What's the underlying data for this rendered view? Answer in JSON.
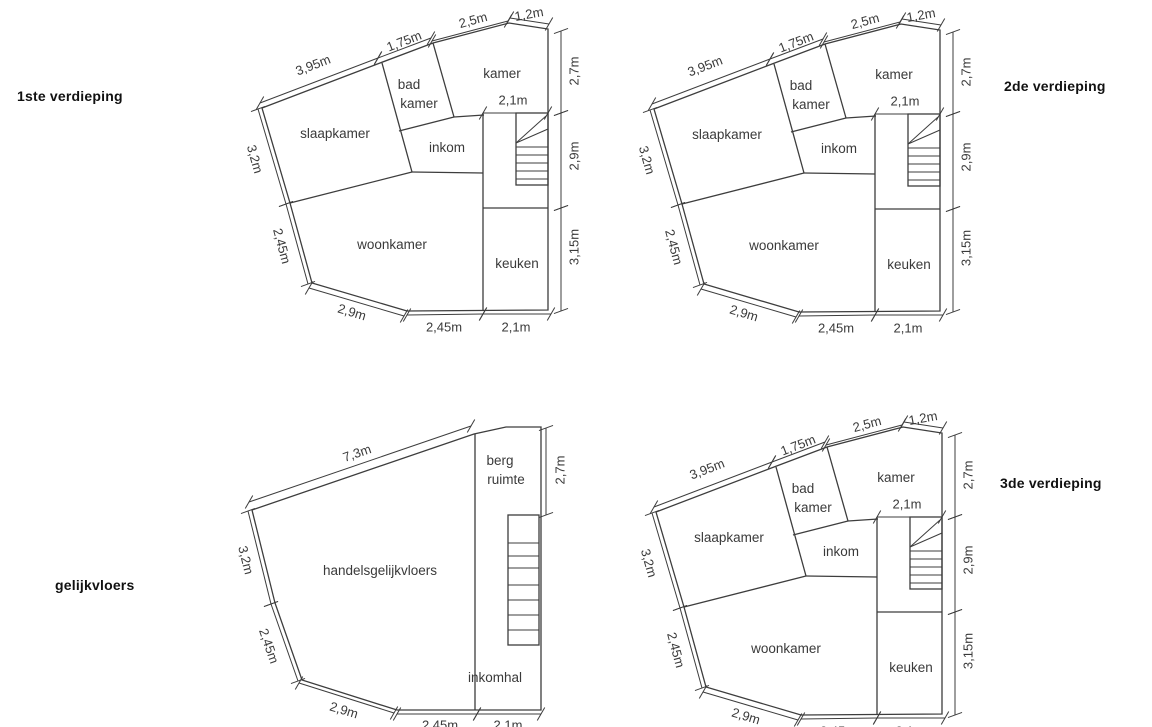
{
  "colors": {
    "background": "#ffffff",
    "line": "#3d3d3d",
    "text": "#3a3a3a",
    "floor_label": "#111111"
  },
  "plans": [
    {
      "id": "1ste-verdieping",
      "label": "1ste verdieping",
      "label_pos": [
        17,
        88
      ],
      "geometry": "standard",
      "offset": [
        0,
        0
      ]
    },
    {
      "id": "2de-verdieping",
      "label": "2de verdieping",
      "label_pos": [
        1004,
        78
      ],
      "geometry": "standard",
      "offset": [
        392,
        1
      ]
    },
    {
      "id": "gelijkvloers",
      "label": "gelijkvloers",
      "label_pos": [
        55,
        577
      ],
      "geometry": "ground",
      "offset": [
        0,
        0
      ]
    },
    {
      "id": "3de-verdieping",
      "label": "3de verdieping",
      "label_pos": [
        1000,
        475
      ],
      "geometry": "standard",
      "offset": [
        394,
        404
      ]
    }
  ],
  "geometries": {
    "standard": {
      "outline": [
        [
          262,
          108
        ],
        [
          380,
          63
        ],
        [
          433,
          43
        ],
        [
          509,
          23
        ],
        [
          548,
          29
        ],
        [
          548,
          310
        ],
        [
          407,
          311
        ],
        [
          312,
          283
        ],
        [
          290,
          203
        ]
      ],
      "walls": [
        [
          382,
          63,
          412,
          172
        ],
        [
          399,
          131,
          454,
          117
        ],
        [
          433,
          43,
          454,
          117
        ],
        [
          454,
          117,
          484,
          115
        ],
        [
          412,
          172,
          483,
          173
        ],
        [
          290,
          203,
          412,
          172
        ],
        [
          483,
          113,
          483,
          310
        ],
        [
          483,
          208,
          548,
          208
        ]
      ],
      "stairs": {
        "box": [
          516,
          113,
          548,
          185
        ],
        "treads": [
          147,
          155,
          163,
          171,
          179
        ],
        "arrows": [
          [
            516,
            143,
            546,
            116
          ],
          [
            516,
            143,
            548,
            129
          ]
        ]
      },
      "rooms": [
        {
          "label": "slaapkamer",
          "lines": [
            {
              "t": "slaapkamer",
              "x": 335,
              "y": 138
            }
          ]
        },
        {
          "label": "bad kamer",
          "lines": [
            {
              "t": "bad",
              "x": 409,
              "y": 89
            },
            {
              "t": "kamer",
              "x": 419,
              "y": 108
            }
          ]
        },
        {
          "label": "kamer",
          "lines": [
            {
              "t": "kamer",
              "x": 502,
              "y": 78
            }
          ]
        },
        {
          "label": "inkom",
          "lines": [
            {
              "t": "inkom",
              "x": 447,
              "y": 152
            }
          ]
        },
        {
          "label": "woonkamer",
          "lines": [
            {
              "t": "woonkamer",
              "x": 392,
              "y": 249
            }
          ]
        },
        {
          "label": "keuken",
          "lines": [
            {
              "t": "keuken",
              "x": 517,
              "y": 268
            }
          ]
        }
      ],
      "dims": [
        {
          "label": "3,95m",
          "line": [
            260,
            103,
            378,
            58
          ],
          "lx": 313,
          "ly": 65,
          "rot": -21
        },
        {
          "label": "1,75m",
          "line": [
            378,
            58,
            431,
            38
          ],
          "lx": 404,
          "ly": 41,
          "rot": -21
        },
        {
          "label": "2,5m",
          "line": [
            432,
            41,
            508,
            21
          ],
          "lx": 473,
          "ly": 20,
          "rot": -15
        },
        {
          "label": "1,2m",
          "line": [
            510,
            18,
            549,
            24
          ],
          "lx": 529,
          "ly": 14,
          "rot": -10
        },
        {
          "label": "2,7m",
          "line": [
            561,
            31,
            561,
            113
          ],
          "lx": 574,
          "ly": 71,
          "rot": -90
        },
        {
          "label": "2,9m",
          "line": [
            561,
            113,
            561,
            208
          ],
          "lx": 574,
          "ly": 156,
          "rot": -90
        },
        {
          "label": "3,15m",
          "line": [
            561,
            208,
            561,
            311
          ],
          "lx": 574,
          "ly": 247,
          "rot": -90
        },
        {
          "label": "2,1m",
          "line": [
            483,
            113,
            548,
            113
          ],
          "lx": 513,
          "ly": 100,
          "rot": 0
        },
        {
          "label": "2,45m",
          "line": [
            407,
            315,
            483,
            314
          ],
          "lx": 444,
          "ly": 327,
          "rot": 0
        },
        {
          "label": "2,1m",
          "line": [
            483,
            314,
            551,
            314
          ],
          "lx": 516,
          "ly": 327,
          "rot": 0
        },
        {
          "label": "2,9m",
          "line": [
            309,
            288,
            404,
            316
          ],
          "lx": 352,
          "ly": 312,
          "rot": 17
        },
        {
          "label": "2,45m",
          "line": [
            286,
            204,
            308,
            284
          ],
          "lx": 282,
          "ly": 246,
          "rot": 75
        },
        {
          "label": "3,2m",
          "line": [
            258,
            109,
            286,
            204
          ],
          "lx": 255,
          "ly": 159,
          "rot": 74
        }
      ]
    },
    "ground": {
      "outline": [
        [
          252,
          510
        ],
        [
          474,
          434
        ],
        [
          506,
          427
        ],
        [
          541,
          427
        ],
        [
          541,
          710
        ],
        [
          397,
          710
        ],
        [
          302,
          680
        ],
        [
          275,
          603
        ]
      ],
      "walls": [
        [
          475,
          434,
          475,
          710
        ]
      ],
      "stairs": {
        "box": [
          508,
          515,
          539,
          645
        ],
        "treads": [
          543,
          556,
          568,
          585,
          600,
          615,
          630
        ],
        "arrows": []
      },
      "rooms": [
        {
          "label": "handelsgelijkvloers",
          "lines": [
            {
              "t": "handelsgelijkvloers",
              "x": 380,
              "y": 575
            }
          ]
        },
        {
          "label": "berg ruimte",
          "lines": [
            {
              "t": "berg",
              "x": 500,
              "y": 465
            },
            {
              "t": "ruimte",
              "x": 506,
              "y": 484
            }
          ]
        },
        {
          "label": "inkomhal",
          "lines": [
            {
              "t": "inkomhal",
              "x": 495,
              "y": 682
            }
          ]
        }
      ],
      "dims": [
        {
          "label": "7,3m",
          "line": [
            249,
            502,
            471,
            426
          ],
          "lx": 357,
          "ly": 453,
          "rot": -19
        },
        {
          "label": "3,2m",
          "line": [
            248,
            511,
            271,
            604
          ],
          "lx": 246,
          "ly": 560,
          "rot": 76
        },
        {
          "label": "2,45m",
          "line": [
            271,
            604,
            298,
            681
          ],
          "lx": 269,
          "ly": 646,
          "rot": 71
        },
        {
          "label": "2,9m",
          "line": [
            299,
            683,
            394,
            713
          ],
          "lx": 344,
          "ly": 710,
          "rot": 17
        },
        {
          "label": "2,45m",
          "line": [
            397,
            714,
            477,
            714
          ],
          "lx": 440,
          "ly": 725,
          "rot": 0
        },
        {
          "label": "2,1m",
          "line": [
            477,
            714,
            541,
            714
          ],
          "lx": 508,
          "ly": 725,
          "rot": 0
        },
        {
          "label": "2,7m",
          "line": [
            546,
            428,
            546,
            515
          ],
          "lx": 560,
          "ly": 470,
          "rot": -90
        }
      ]
    }
  }
}
